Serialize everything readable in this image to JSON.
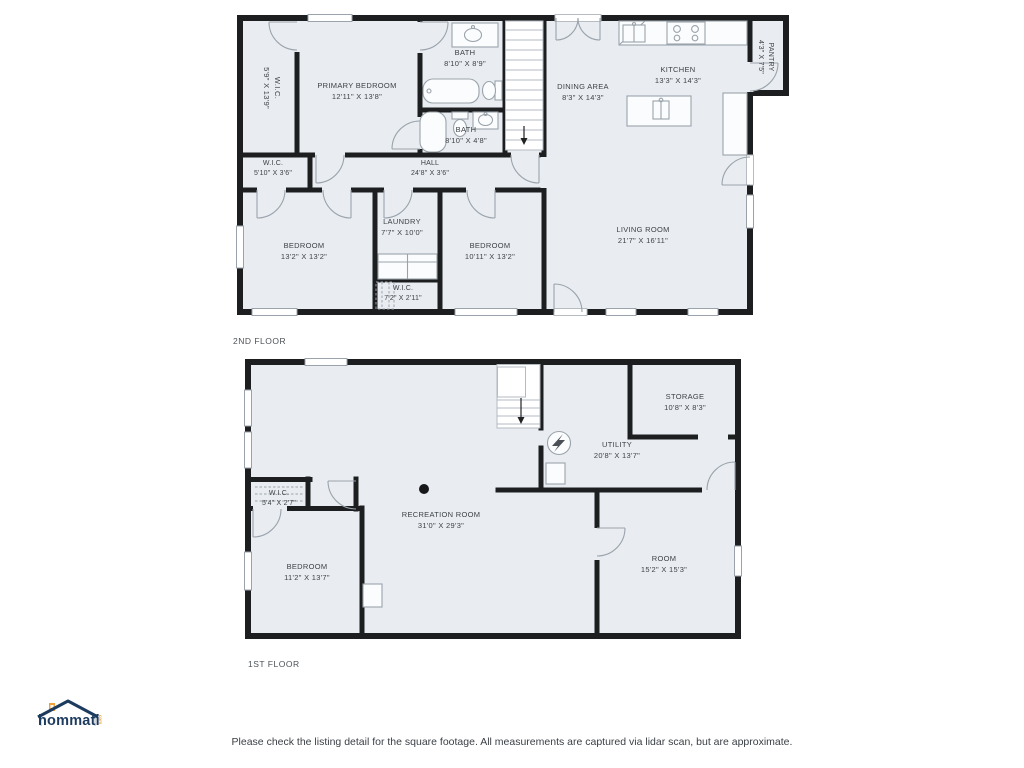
{
  "floor2": {
    "label": "2ND FLOOR",
    "rooms": {
      "wic1": {
        "name": "W.I.C.",
        "dims": "5'9\" X 13'9\""
      },
      "primary": {
        "name": "PRIMARY BEDROOM",
        "dims": "12'11\" X 13'8\""
      },
      "bath1": {
        "name": "BATH",
        "dims": "8'10\" X 8'9\""
      },
      "bath2": {
        "name": "BATH",
        "dims": "8'10\" X 4'8\""
      },
      "dining": {
        "name": "DINING AREA",
        "dims": "8'3\" X 14'3\""
      },
      "kitchen": {
        "name": "KITCHEN",
        "dims": "13'3\" X 14'3\""
      },
      "pantry": {
        "name": "PANTRY",
        "dims": "4'3\" X 7'5\""
      },
      "wic2": {
        "name": "W.I.C.",
        "dims": "5'10\" X 3'6\""
      },
      "hall": {
        "name": "HALL",
        "dims": "24'8\" X 3'6\""
      },
      "bedroom1": {
        "name": "BEDROOM",
        "dims": "13'2\" X 13'2\""
      },
      "laundry": {
        "name": "LAUNDRY",
        "dims": "7'7\" X 10'0\""
      },
      "wic3": {
        "name": "W.I.C.",
        "dims": "7'2\" X 2'11\""
      },
      "bedroom2": {
        "name": "BEDROOM",
        "dims": "10'11\" X 13'2\""
      },
      "living": {
        "name": "LIVING ROOM",
        "dims": "21'7\" X 16'11\""
      }
    }
  },
  "floor1": {
    "label": "1ST FLOOR",
    "rooms": {
      "storage": {
        "name": "STORAGE",
        "dims": "10'8\" X 8'3\""
      },
      "utility": {
        "name": "UTILITY",
        "dims": "20'8\" X 13'7\""
      },
      "wic4": {
        "name": "W.I.C.",
        "dims": "5'4\" X 2'7\""
      },
      "recreation": {
        "name": "RECREATION ROOM",
        "dims": "31'0\" X 29'3\""
      },
      "bedroom3": {
        "name": "BEDROOM",
        "dims": "11'2\" X 13'7\""
      },
      "room": {
        "name": "ROOM",
        "dims": "15'2\" X 15'3\""
      }
    }
  },
  "logo": {
    "text": "hommati",
    "suffix": "com"
  },
  "footer": {
    "disclaimer": "Please check the listing detail for the square footage. All measurements are captured via lidar scan, but are approximate."
  },
  "colors": {
    "room_fill": "#e9edf2",
    "wall": "#1d1e20",
    "fixture_line": "#9aa3ab",
    "label_text": "#3d4247",
    "logo_navy": "#1c3b5e",
    "logo_orange": "#f0a239"
  }
}
